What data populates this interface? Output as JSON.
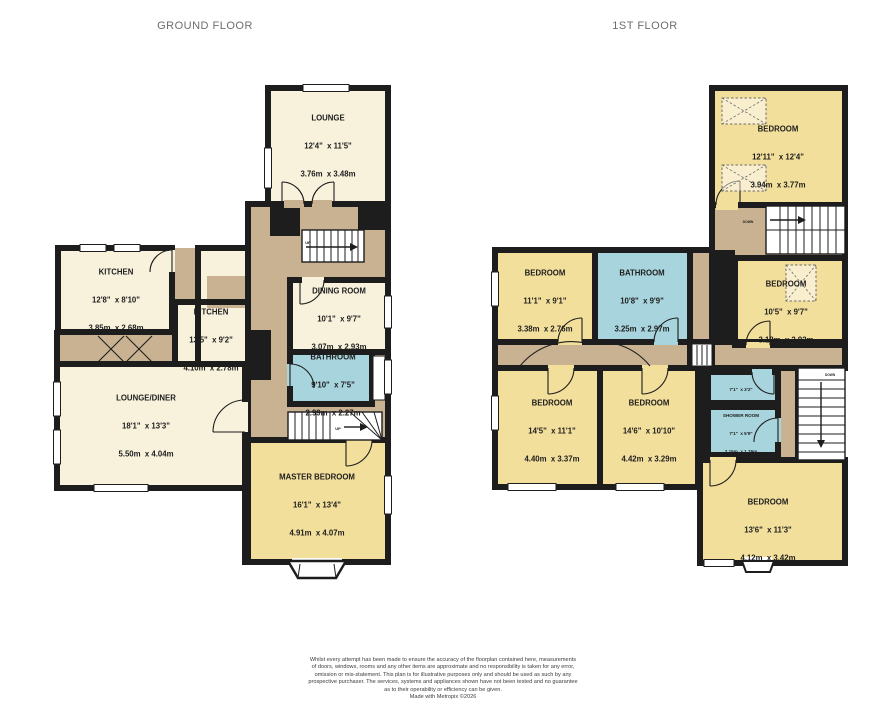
{
  "colors": {
    "wall": "#1d1d1d",
    "room_cream": "#f8f2dd",
    "room_yellow": "#f3df9c",
    "room_blue": "#a8d4dd",
    "hallway_tan": "#c9b291",
    "title_gray": "#6e6e6e",
    "label_dark": "#1d1d1d",
    "footer_gray": "#3c3c3c"
  },
  "ground_floor": {
    "title": "GROUND FLOOR",
    "rooms": [
      {
        "name": "LOUNGE",
        "imperial": "12'4\"  x 11'5\"",
        "metric": "3.76m  x 3.48m"
      },
      {
        "name": "KITCHEN",
        "imperial": "12'8\"  x 8'10\"",
        "metric": "3.85m  x 2.68m"
      },
      {
        "name": "KITCHEN",
        "imperial": "13'5\"  x 9'2\"",
        "metric": "4.10m  x 2.78m"
      },
      {
        "name": "DINING ROOM",
        "imperial": "10'1\"  x 9'7\"",
        "metric": "3.07m  x 2.93m"
      },
      {
        "name": "BATHROOM",
        "imperial": "9'10\"  x 7'5\"",
        "metric": "2.99m  x 2.27m"
      },
      {
        "name": "LOUNGE/DINER",
        "imperial": "18'1\"  x 13'3\"",
        "metric": "5.50m  x 4.04m"
      },
      {
        "name": "MASTER BEDROOM",
        "imperial": "16'1\"  x 13'4\"",
        "metric": "4.91m  x 4.07m"
      }
    ],
    "stairs": [
      {
        "label": "UP"
      },
      {
        "label": "UP"
      }
    ]
  },
  "first_floor": {
    "title": "1ST FLOOR",
    "rooms": [
      {
        "name": "BEDROOM",
        "imperial": "12'11\"  x 12'4\"",
        "metric": "3.94m  x 3.77m"
      },
      {
        "name": "BEDROOM",
        "imperial": "11'1\"  x 9'1\"",
        "metric": "3.38m  x 2.76m"
      },
      {
        "name": "BATHROOM",
        "imperial": "10'8\"  x 9'9\"",
        "metric": "3.25m  x 2.97m"
      },
      {
        "name": "BEDROOM",
        "imperial": "10'5\"  x 9'7\"",
        "metric": "3.18m  x 2.92m"
      },
      {
        "name": "BEDROOM",
        "imperial": "14'5\"  x 11'1\"",
        "metric": "4.40m  x 3.37m"
      },
      {
        "name": "BEDROOM",
        "imperial": "14'6\"  x 10'10\"",
        "metric": "4.42m  x 3.29m"
      },
      {
        "name": "WC",
        "imperial": "7'1\"  x 3'2\"",
        "metric": "2.15m  x 0.96m"
      },
      {
        "name": "SHOWER ROOM",
        "imperial": "7'1\"  x 5'9\"",
        "metric": "2.15m  x 1.76m"
      },
      {
        "name": "BEDROOM",
        "imperial": "13'6\"  x 11'3\"",
        "metric": "4.12m  x 3.42m"
      }
    ],
    "stairs": [
      {
        "label": "DOWN"
      },
      {
        "label": "DOWN"
      }
    ]
  },
  "footer": {
    "lines": [
      "Whilst every attempt has been made to ensure the accuracy of the floorplan contained here, measurements",
      "of doors, windows, rooms and any other items are approximate and no responsibility is taken for any error,",
      "omission or mis-statement. This plan is for illustrative purposes only and should be used as such by any",
      "prospective purchaser. The services, systems and appliances shown have not been tested and no guarantee",
      "as to their operability or efficiency can be given.",
      "Made with Metropix ©2026"
    ]
  }
}
